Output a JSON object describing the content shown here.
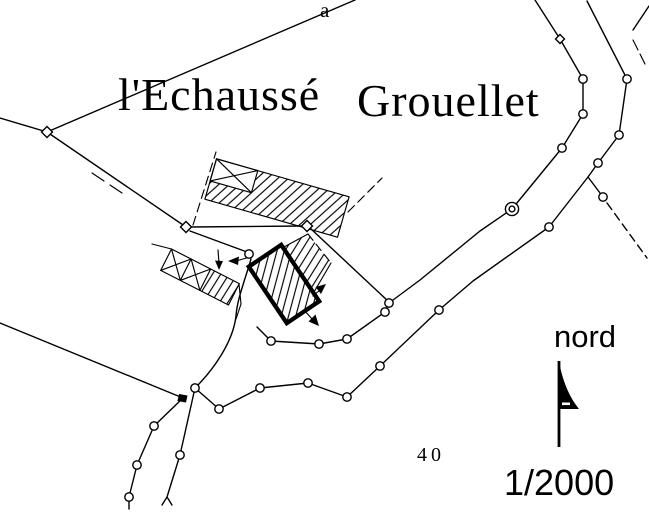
{
  "map": {
    "labels": {
      "hamlet_west": "l'Echaussé",
      "hamlet_east": "Grouellet",
      "parcel_letter": "a",
      "parcel_number": "40"
    },
    "compass": {
      "label": "nord"
    },
    "scale": {
      "label": "1/2000"
    },
    "colors": {
      "ink": "#000000",
      "paper": "#ffffff"
    }
  }
}
